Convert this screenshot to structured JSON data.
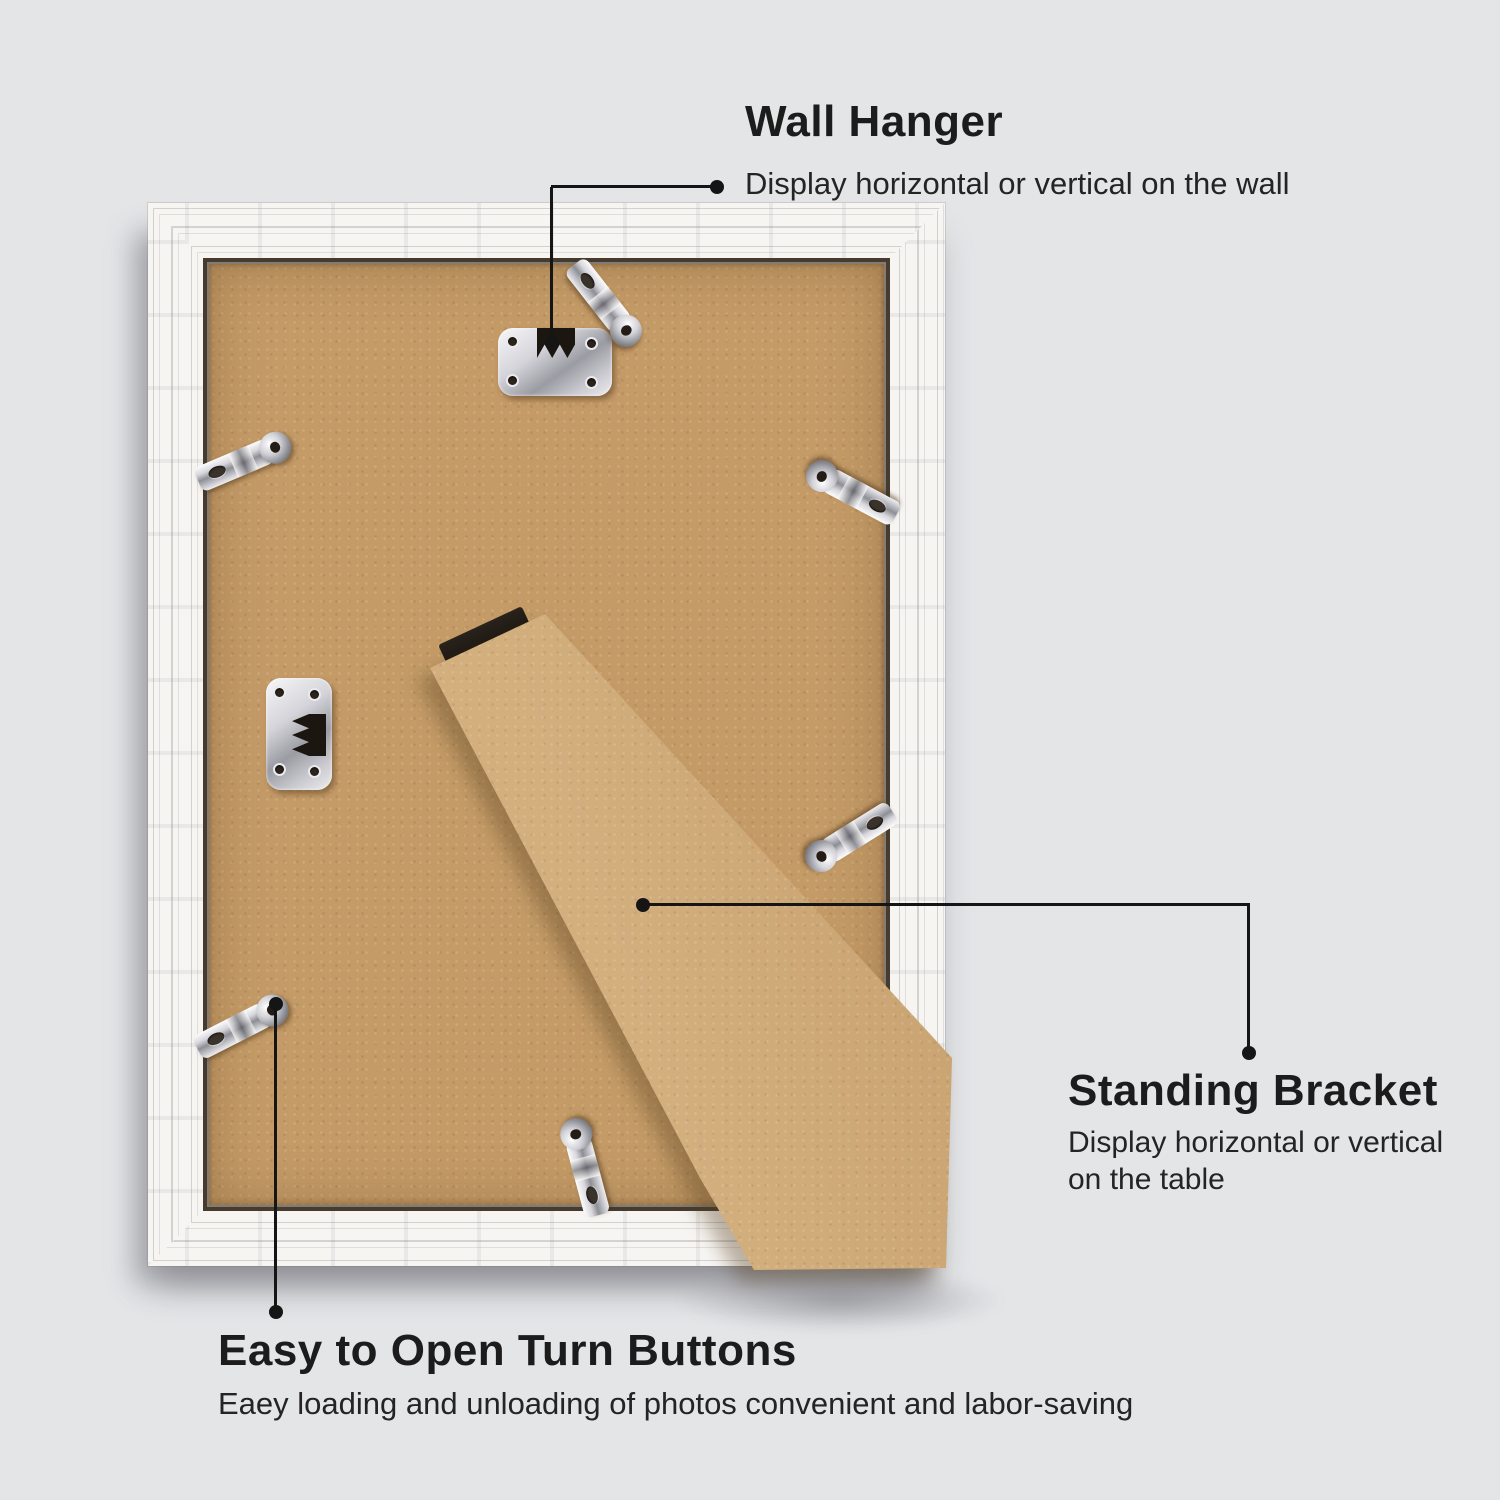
{
  "annotations": {
    "wall_hanger": {
      "title": "Wall Hanger",
      "subtitle": "Display horizontal or vertical on the wall"
    },
    "standing_bracket": {
      "title": "Standing Bracket",
      "subtitle_line1": "Display horizontal or vertical",
      "subtitle_line2": "on the table"
    },
    "turn_buttons": {
      "title": "Easy to Open Turn Buttons",
      "subtitle": "Eaey loading and unloading of photos convenient and labor-saving"
    }
  },
  "colors": {
    "background": "#e4e5e7",
    "frame_white": "#f7f5f2",
    "backing_kraft": "#c49b67",
    "bracket_kraft": "#cfa873",
    "metal_silver": "#c9c9d0",
    "leader_line": "#151515",
    "text": "#1c1c1c"
  }
}
